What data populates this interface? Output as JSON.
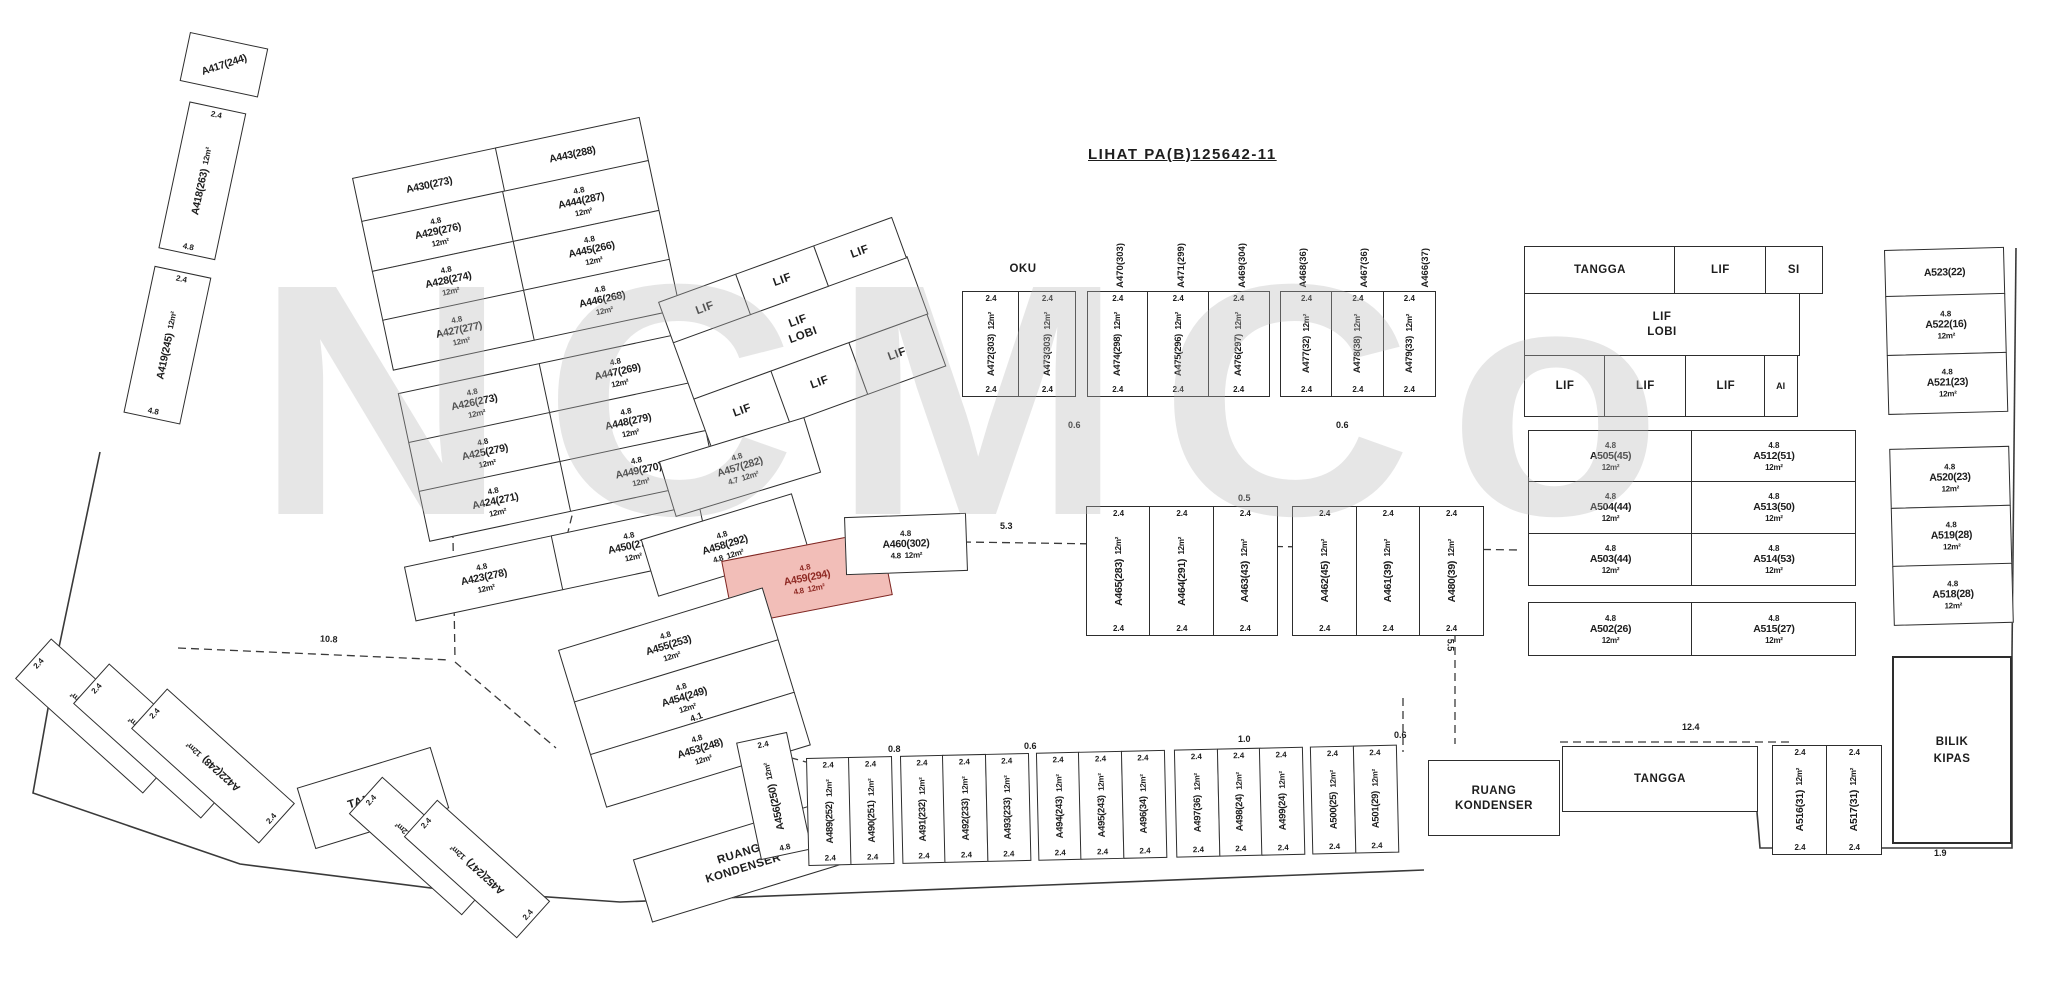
{
  "title": "LIHAT PA(B)125642-11",
  "watermark": "NCMCo",
  "labels": {
    "lif": "LIF",
    "lobi": "LOBI",
    "tangga": "TANGGA",
    "oku": "OKU",
    "ruang": "RUANG",
    "kondenser": "KONDENSER",
    "bilik": "BILIK",
    "kipas": "KIPAS",
    "si": "SI",
    "ai": "AI",
    "area": "12m²"
  },
  "c": {
    "v24": "2.4",
    "h48": "4.8",
    "d47": "4.7"
  },
  "colors": {
    "highlight_fill": "#f2beb8",
    "highlight_text": "#8f2a24",
    "line": "#2d2d2d",
    "watermark": "#b9b9b9"
  },
  "clusters": {
    "strip": {
      "header": "A417(244)",
      "units": [
        "A418(263)",
        "A419(245)"
      ]
    },
    "left": {
      "headers": [
        "A430(273)",
        "A443(288)"
      ],
      "col_left": [
        "A429(276)",
        "A428(274)",
        "A427(277)",
        "A426(273)",
        "A425(279)",
        "A424(271)"
      ],
      "col_right": [
        "A444(287)",
        "A445(266)",
        "A446(268)",
        "A447(269)",
        "A448(279)",
        "A449(270)"
      ],
      "bottom": [
        "A423(278)",
        "A450(270)"
      ]
    },
    "mid_lif": {
      "shafts": [
        "LIF",
        "LIF",
        "LIF"
      ],
      "cells": [
        "LIF",
        "LIF",
        "LIF"
      ],
      "service_cells": [
        "M",
        "SI",
        "BY",
        "SI",
        "B"
      ]
    },
    "a457": "A457(282)",
    "a458": "A458(292)",
    "red_unit": "A459(294)",
    "a460": "A460(302)",
    "oku": {
      "top_labels": [
        "A470(303)",
        "A471(299)",
        "A469(304)",
        "A468(36)",
        "A467(36)",
        "A466(37)"
      ],
      "g1": [
        "A472(303)",
        "A473(303)"
      ],
      "g2": [
        "A474(298)",
        "A475(296)",
        "A476(297)"
      ],
      "g3": [
        "A477(32)",
        "A478(38)",
        "A479(33)"
      ]
    },
    "mid_row": {
      "g1": [
        "A465(283)",
        "A464(291)",
        "A463(43)"
      ],
      "g2": [
        "A462(45)",
        "A461(39)",
        "A480(39)"
      ]
    },
    "right_grid": {
      "r1": [
        "A505(45)",
        "A512(51)"
      ],
      "r2": [
        "A504(44)",
        "A513(50)"
      ],
      "r3": [
        "A503(44)",
        "A514(53)"
      ],
      "r4": [
        "A502(26)",
        "A515(27)"
      ]
    },
    "far_right": {
      "header": "A523(22)",
      "upper": [
        "A522(16)",
        "A521(23)"
      ],
      "lower": [
        "A520(23)",
        "A519(28)",
        "A518(28)"
      ]
    },
    "bl_units": [
      "A420(255)",
      "A421(253)",
      "A422(248)"
    ],
    "a451_452": [
      "A451(254)",
      "A452(247)"
    ],
    "mid_cluster": [
      "A455(253)",
      "A454(249)",
      "A453(248)"
    ],
    "a456": "A456(250)",
    "bottom_row": {
      "g1": [
        "A489(252)",
        "A490(251)"
      ],
      "g2": [
        "A491(232)",
        "A492(233)",
        "A493(233)"
      ],
      "g3": [
        "A494(243)",
        "A495(243)",
        "A496(34)"
      ],
      "g4": [
        "A497(36)",
        "A498(24)",
        "A499(24)"
      ],
      "g5": [
        "A500(25)",
        "A501(29)"
      ]
    },
    "a516_517": [
      "A516(31)",
      "A517(31)"
    ]
  },
  "dims": [
    {
      "t": "10.8",
      "x": 320,
      "y": 634,
      "r": 3
    },
    {
      "t": "4.1",
      "x": 690,
      "y": 712,
      "r": -20
    },
    {
      "t": "5.3",
      "x": 1000,
      "y": 521,
      "r": 0
    },
    {
      "t": "0.5",
      "x": 1238,
      "y": 493,
      "r": 0
    },
    {
      "t": "0.6",
      "x": 1068,
      "y": 420,
      "r": 0
    },
    {
      "t": "0.6",
      "x": 1336,
      "y": 420,
      "r": 0
    },
    {
      "t": "5.5",
      "x": 1444,
      "y": 640,
      "r": 90
    },
    {
      "t": "12.4",
      "x": 1682,
      "y": 722,
      "r": 0
    },
    {
      "t": "0.8",
      "x": 888,
      "y": 744,
      "r": 0
    },
    {
      "t": "0.6",
      "x": 1024,
      "y": 741,
      "r": 0
    },
    {
      "t": "1.0",
      "x": 1238,
      "y": 734,
      "r": 0
    },
    {
      "t": "0.6",
      "x": 1394,
      "y": 730,
      "r": 0
    },
    {
      "t": "1.9",
      "x": 1934,
      "y": 848,
      "r": 0
    }
  ]
}
